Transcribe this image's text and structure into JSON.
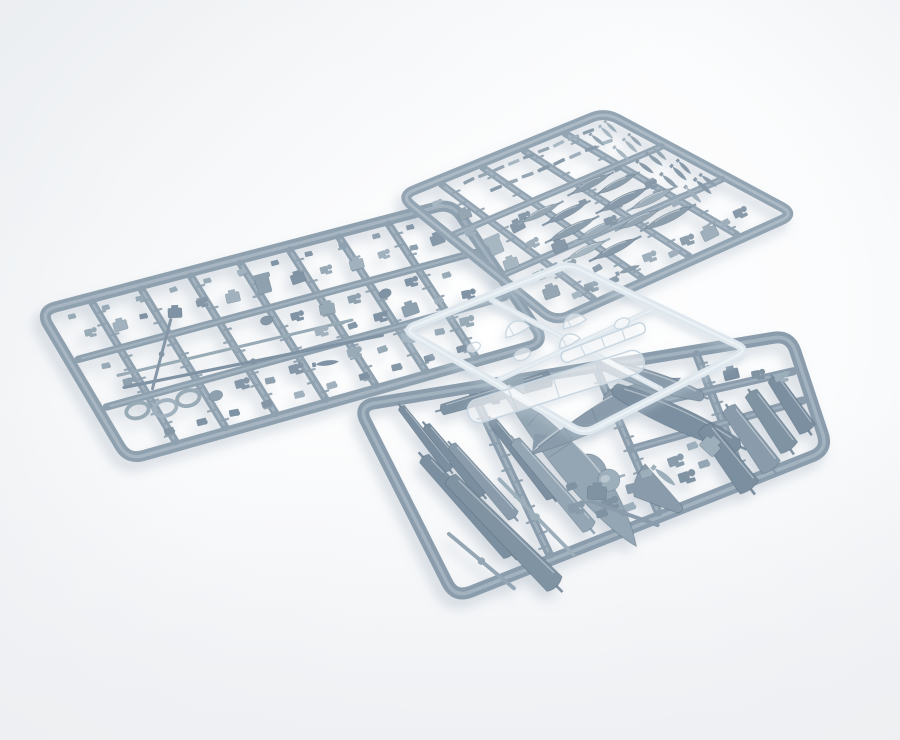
{
  "image": {
    "subject": "Photograph of injection-moulded model kit sprues: three grey plastic runners with aircraft parts and one clear-parts sprue on a white background"
  },
  "background": {
    "center": "#ffffff",
    "mid": "#fbfcfd",
    "edge": "#eef0f3",
    "corner_tint": "#e9ecef",
    "bottom_tint": "#edeff2"
  },
  "palette": {
    "part_fills": [
      "#8093a3",
      "#8a9cab",
      "#94a6b3",
      "#7b8fa0",
      "#9dafbb"
    ],
    "part_stroke": "rgba(70,93,110,0.35)",
    "highlight": "rgba(255,255,255,0.4)",
    "clear_fill": "rgba(255,255,255,0.55)",
    "clear_stroke": "#c9d7e2",
    "shadow_grey": "#8fa0b0",
    "shadow_clear": "#b8c6d2"
  },
  "sprues": [
    {
      "name": "left-detail-sprue",
      "kind": "grey",
      "frame_color": "#8fa1af",
      "frame_highlight": "#b6c3cd",
      "frame_width": 11,
      "corner_radius": 16,
      "lighten": 0.04,
      "depth": [
        0.8,
        0.35
      ],
      "seed": 11,
      "corners": [
        [
          40,
          311
        ],
        [
          452,
          203
        ],
        [
          545,
          342
        ],
        [
          128,
          460
        ]
      ],
      "runners": {
        "u": [
          0.12,
          0.24,
          0.36,
          0.48,
          0.6,
          0.72,
          0.84
        ],
        "v": [
          {
            "pos": 0.34,
            "u0": 0.02,
            "u1": 0.98
          },
          {
            "pos": 0.66,
            "u0": 0.02,
            "u1": 0.98
          }
        ]
      },
      "ticks": true,
      "parts": [
        {
          "row": [
            "tiny",
            0.06,
            0.08,
            0.082,
            11,
            0
          ]
        },
        [
          "clump",
          0.08,
          0.2
        ],
        [
          "block",
          0.15,
          0.21
        ],
        [
          "tiny",
          0.21,
          0.19
        ],
        [
          "block",
          0.28,
          0.22,
          14
        ],
        [
          "clump",
          0.35,
          0.2
        ],
        [
          "block",
          0.42,
          0.22
        ],
        [
          "seat",
          0.5,
          0.19,
          0,
          1.15
        ],
        [
          "block",
          0.58,
          0.21
        ],
        [
          "clump",
          0.65,
          0.2
        ],
        [
          "block",
          0.72,
          0.22
        ],
        [
          "clump",
          0.79,
          0.2
        ],
        [
          "tiny",
          0.86,
          0.21
        ],
        [
          "block",
          0.92,
          0.2
        ],
        [
          "tiny",
          0.07,
          0.42
        ],
        [
          "clump",
          0.1,
          0.55
        ],
        [
          "blade",
          0.36,
          0.52,
          2,
          3.6
        ],
        [
          "blade",
          0.38,
          0.63,
          4,
          3.8
        ],
        [
          "blade",
          0.2,
          0.44,
          -60,
          1.1
        ],
        [
          "disc",
          0.46,
          0.41
        ],
        [
          "clump",
          0.53,
          0.43
        ],
        [
          "block",
          0.6,
          0.44
        ],
        [
          "clump",
          0.67,
          0.42
        ],
        [
          "disc",
          0.74,
          0.44
        ],
        [
          "clump",
          0.81,
          0.41
        ],
        [
          "tiny",
          0.89,
          0.43
        ],
        [
          "clump",
          0.56,
          0.56
        ],
        [
          "tiny",
          0.63,
          0.58
        ],
        [
          "clump",
          0.7,
          0.57
        ],
        [
          "block",
          0.77,
          0.58
        ],
        [
          "tiny",
          0.84,
          0.57
        ],
        [
          "clump",
          0.91,
          0.58
        ],
        [
          "ring",
          0.08,
          0.73,
          0,
          1.2
        ],
        [
          "ring",
          0.14,
          0.76,
          0,
          1.2
        ],
        [
          "ring",
          0.2,
          0.74,
          0,
          1.2
        ],
        [
          "disc",
          0.26,
          0.77
        ],
        [
          "clump",
          0.33,
          0.74
        ],
        [
          "tiny",
          0.39,
          0.77
        ],
        [
          "clump",
          0.46,
          0.74
        ],
        [
          "bomb",
          0.53,
          0.76,
          12,
          1.1
        ],
        [
          "clump",
          0.6,
          0.74
        ],
        [
          "tiny",
          0.66,
          0.77
        ],
        [
          "clump",
          0.73,
          0.74
        ],
        [
          "tiny",
          0.8,
          0.76
        ],
        [
          "clump",
          0.87,
          0.74
        ],
        {
          "row": [
            "tiny",
            0.12,
            0.9,
            0.078,
            10,
            0
          ]
        }
      ]
    },
    {
      "name": "top-weapons-sprue",
      "kind": "grey",
      "frame_color": "#93a4b2",
      "frame_highlight": "#bcc9d3",
      "frame_width": 10,
      "corner_radius": 15,
      "lighten": 0.1,
      "depth": [
        0.72,
        0.33
      ],
      "seed": 23,
      "corners": [
        [
          400,
          196
        ],
        [
          605,
          112
        ],
        [
          795,
          214
        ],
        [
          555,
          322
        ]
      ],
      "runners": {
        "u": [
          0.18,
          0.38,
          0.58,
          0.78
        ],
        "v": [
          {
            "pos": 0.32,
            "u0": 0.02,
            "u1": 0.98
          },
          {
            "pos": 0.64,
            "u0": 0.02,
            "u1": 0.98
          }
        ]
      },
      "ticks": true,
      "parts": [
        {
          "row": [
            "flatbit",
            0.28,
            0.07,
            0.072,
            9,
            0
          ]
        },
        {
          "row": [
            "flatbit",
            0.33,
            0.17,
            0.075,
            8,
            0
          ]
        },
        [
          "clump",
          0.09,
          0.12
        ],
        [
          "block",
          0.13,
          0.24
        ],
        [
          "clump",
          0.08,
          0.34
        ],
        [
          "seat",
          0.1,
          0.47,
          0,
          1.1
        ],
        [
          "block",
          0.08,
          0.6
        ],
        [
          "clump",
          0.12,
          0.72
        ],
        [
          "block",
          0.09,
          0.84
        ],
        [
          "tiny",
          0.15,
          0.91
        ],
        [
          "block",
          0.24,
          0.42
        ],
        [
          "clump",
          0.3,
          0.38
        ],
        [
          "clump",
          0.22,
          0.54
        ],
        [
          "block",
          0.28,
          0.62
        ],
        [
          "clump",
          0.24,
          0.74
        ],
        [
          "tiny",
          0.3,
          0.82
        ],
        [
          "tank",
          0.36,
          0.4,
          -4,
          1.0
        ],
        [
          "tank",
          0.43,
          0.46,
          -4,
          1.05
        ],
        [
          "tank",
          0.38,
          0.56,
          -3,
          1.15
        ],
        [
          "tank",
          0.45,
          0.62,
          -3,
          1.0
        ],
        [
          "tank",
          0.34,
          0.7,
          -2,
          0.9
        ],
        [
          "tank",
          0.42,
          0.76,
          -2,
          1.0
        ],
        [
          "tank",
          0.62,
          0.36,
          -4,
          1.05
        ],
        [
          "tank",
          0.69,
          0.42,
          -4,
          1.0
        ],
        [
          "tank",
          0.64,
          0.52,
          -3,
          1.2
        ],
        [
          "tank",
          0.72,
          0.58,
          -3,
          1.05
        ],
        [
          "tank",
          0.6,
          0.66,
          -2,
          0.95
        ],
        [
          "tank",
          0.68,
          0.72,
          -2,
          1.1
        ],
        [
          "tiny",
          0.52,
          0.44
        ],
        [
          "clump",
          0.52,
          0.6
        ],
        [
          "tiny",
          0.76,
          0.34
        ],
        [
          "clump",
          0.78,
          0.5
        ],
        [
          "tiny",
          0.76,
          0.66
        ],
        {
          "col": [
            "bomb",
            0.84,
            0.14,
            0.13,
            5,
            64,
            1.1
          ]
        },
        {
          "col": [
            "bomb",
            0.9,
            0.12,
            0.13,
            5,
            64,
            1.1
          ]
        },
        {
          "col": [
            "bomb",
            0.94,
            0.1,
            0.13,
            5,
            64,
            1.0
          ]
        },
        [
          "clump",
          0.22,
          0.9
        ],
        [
          "tiny",
          0.3,
          0.92
        ],
        [
          "bomb",
          0.38,
          0.9,
          6,
          1.1
        ],
        [
          "clump",
          0.48,
          0.88
        ],
        [
          "tiny",
          0.55,
          0.92
        ],
        [
          "clump",
          0.64,
          0.88
        ],
        [
          "block",
          0.72,
          0.9
        ],
        [
          "tiny",
          0.8,
          0.88
        ],
        [
          "clump",
          0.88,
          0.86
        ]
      ]
    },
    {
      "name": "bottom-airframe-sprue",
      "kind": "grey",
      "frame_color": "#8b9dac",
      "frame_highlight": "#b2c0cb",
      "frame_width": 12,
      "corner_radius": 17,
      "lighten": 0,
      "depth": [
        0.85,
        0.45
      ],
      "seed": 5,
      "corners": [
        [
          358,
          406
        ],
        [
          790,
          335
        ],
        [
          828,
          450
        ],
        [
          455,
          598
        ]
      ],
      "runners": {
        "u": [
          0.26,
          0.55,
          0.78
        ],
        "v": [
          {
            "pos": 0.3,
            "u0": 0.55,
            "u1": 0.98
          },
          {
            "pos": 0.55,
            "u0": 0.55,
            "u1": 0.98
          }
        ]
      },
      "ticks": true,
      "parts": [
        [
          "flap",
          0.11,
          0.22,
          64,
          0.9
        ],
        [
          "flap",
          0.15,
          0.36,
          64,
          0.95
        ],
        [
          "flap",
          0.19,
          0.5,
          64,
          0.95
        ],
        [
          "flap",
          0.13,
          0.6,
          64,
          1.25
        ],
        [
          "flap",
          0.18,
          0.78,
          64,
          1.35
        ],
        [
          "blade",
          0.1,
          0.88,
          60,
          1.0
        ],
        [
          "flap",
          0.3,
          0.44,
          66,
          1.0
        ],
        [
          "flap",
          0.34,
          0.62,
          66,
          1.1
        ],
        [
          "blade",
          0.27,
          0.76,
          64,
          1.3
        ],
        [
          "clump",
          0.22,
          0.08
        ],
        [
          "tiny",
          0.3,
          0.1
        ],
        [
          "flap",
          0.31,
          0.06,
          -6,
          1.4
        ],
        [
          "fuselage",
          0.41,
          0.52,
          66,
          1.35
        ],
        [
          "fuselage",
          0.53,
          0.28,
          -14,
          1.15
        ],
        [
          "spinner",
          0.47,
          0.69,
          0,
          1.05
        ],
        [
          "cowl",
          0.66,
          0.16,
          28,
          1.1
        ],
        [
          "cowl",
          0.68,
          0.44,
          38,
          1.25
        ],
        [
          "panel",
          0.76,
          0.8,
          72,
          0.95
        ],
        [
          "panel",
          0.83,
          0.72,
          72,
          0.95
        ],
        [
          "panel",
          0.89,
          0.64,
          72,
          0.9
        ],
        [
          "panel",
          0.95,
          0.56,
          72,
          0.85
        ],
        [
          "wedge",
          0.57,
          0.86,
          58,
          1.05
        ],
        [
          "clump",
          0.45,
          0.82
        ],
        [
          "tiny",
          0.49,
          0.88
        ],
        [
          "block",
          0.43,
          0.74,
          24
        ],
        [
          "clump",
          0.52,
          0.78
        ],
        [
          "tiny",
          0.56,
          0.72
        ],
        [
          "clump",
          0.64,
          0.7
        ],
        [
          "tiny",
          0.69,
          0.64
        ],
        [
          "block",
          0.73,
          0.68,
          58
        ],
        [
          "bomb",
          0.6,
          0.78,
          58,
          1.1
        ],
        [
          "clump",
          0.65,
          0.82
        ],
        [
          "tiny",
          0.7,
          0.78
        ],
        [
          "block",
          0.84,
          0.22
        ],
        [
          "clump",
          0.9,
          0.26
        ],
        [
          "tiny",
          0.8,
          0.14
        ],
        [
          "clump",
          0.95,
          0.32
        ],
        [
          "tiny",
          0.38,
          0.66
        ],
        [
          "clump",
          0.37,
          0.78
        ],
        [
          "tiny",
          0.42,
          0.86
        ],
        [
          "blade",
          0.47,
          0.9,
          40,
          0.85
        ]
      ]
    },
    {
      "name": "clear-parts-sprue",
      "kind": "clear",
      "frame_color": "#dfe8ee",
      "frame_highlight": "#f4f8fa",
      "frame_width": 8,
      "corner_radius": 12,
      "lighten": 0,
      "depth": [
        0.85,
        0.25
      ],
      "seed": 2,
      "corners": [
        [
          404,
          330
        ],
        [
          568,
          264
        ],
        [
          748,
          350
        ],
        [
          584,
          434
        ]
      ],
      "runners": {
        "u": [
          0.5
        ],
        "v": [
          {
            "pos": 0.5,
            "u0": 0.03,
            "u1": 0.97
          }
        ]
      },
      "ticks": false,
      "parts": [
        [
          "screenstrip",
          0.18,
          0.68,
          8,
          1.8
        ],
        [
          "screenstrip",
          0.6,
          0.56,
          4,
          0.9
        ],
        [
          "canopy",
          0.4,
          0.26,
          0,
          1.1
        ],
        [
          "canopy",
          0.64,
          0.36,
          4,
          1.0
        ],
        [
          "canopyS",
          0.26,
          0.42,
          0,
          1.0
        ],
        [
          "canopyS",
          0.78,
          0.5,
          0,
          0.9
        ],
        [
          "canopyS",
          0.14,
          0.26,
          0,
          0.85
        ],
        [
          "canopy",
          0.5,
          0.46,
          0,
          0.9
        ]
      ]
    }
  ]
}
